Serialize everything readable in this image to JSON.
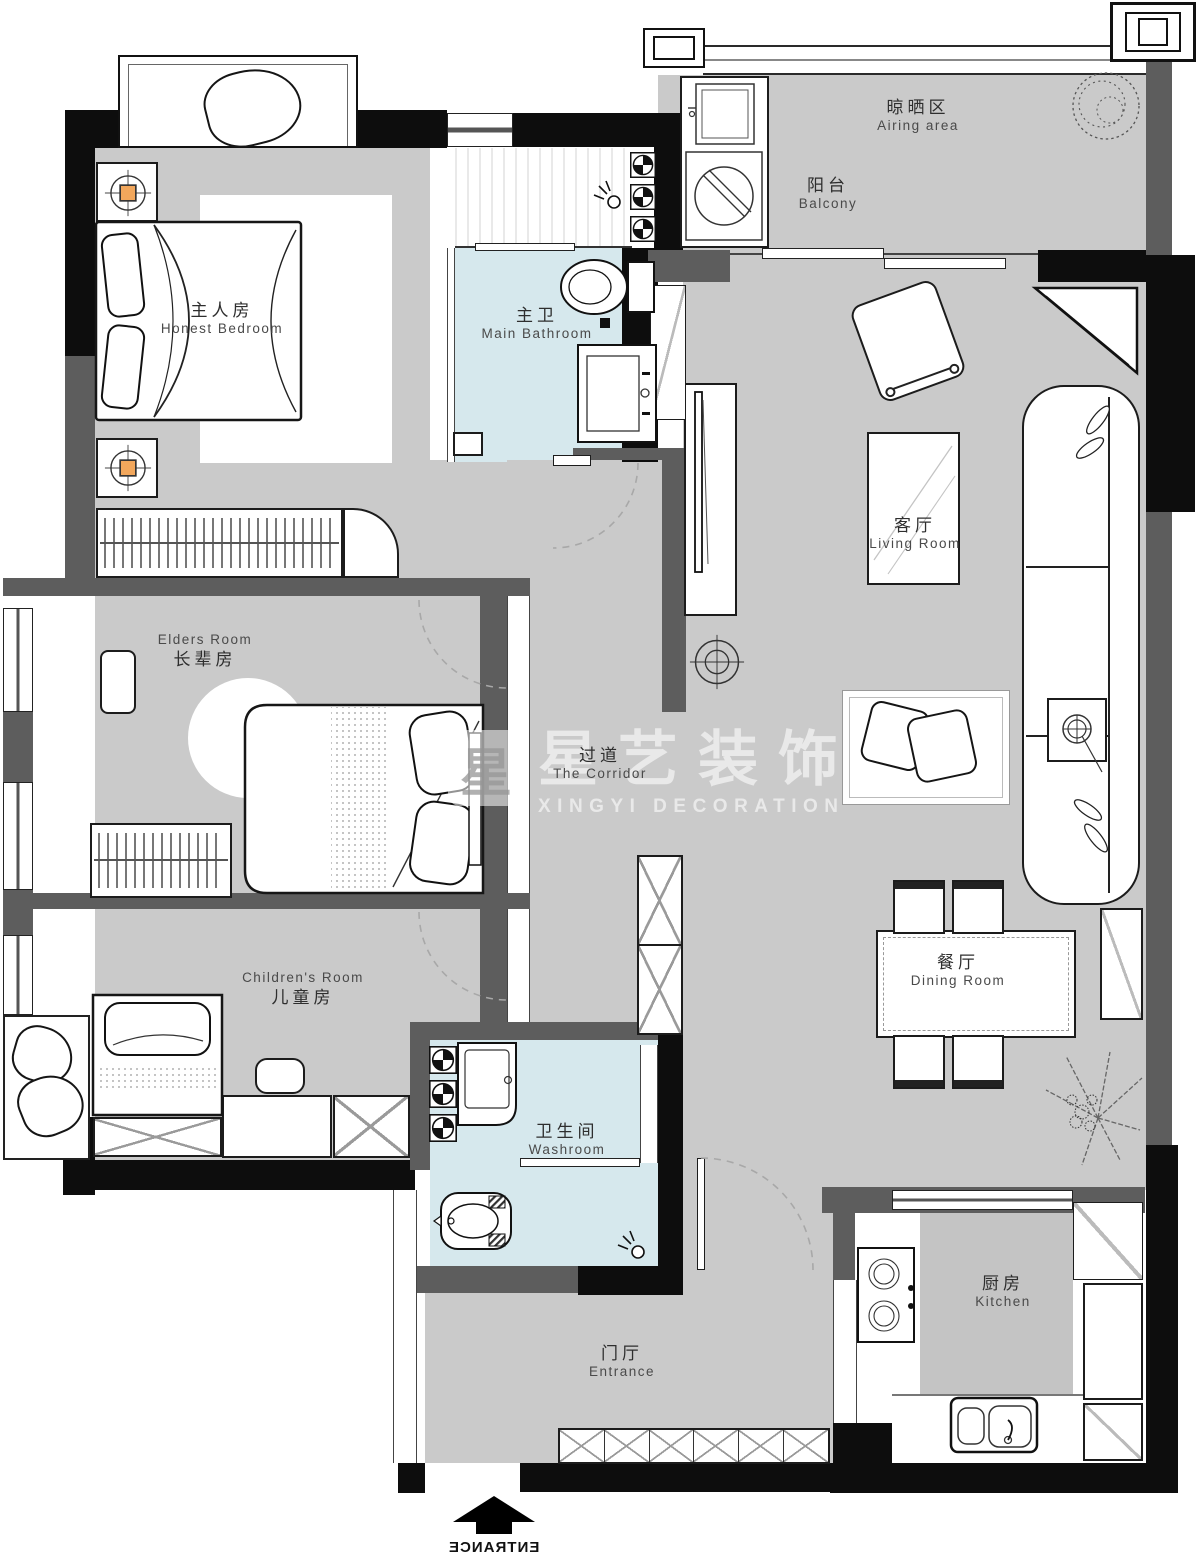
{
  "watermark": {
    "logo_char": "星",
    "title_zh": "星艺装饰",
    "title_en": "XINGYI DECORATION"
  },
  "entrance_marker": "ENTRANCE",
  "rooms": {
    "master_bedroom": {
      "zh": "主人房",
      "en": "Honest Bedroom"
    },
    "main_bathroom": {
      "zh": "主卫",
      "en": "Main Bathroom"
    },
    "airing_area": {
      "zh": "晾晒区",
      "en": "Airing area"
    },
    "balcony": {
      "zh": "阳台",
      "en": "Balcony"
    },
    "living_room": {
      "zh": "客厅",
      "en": "Living Room"
    },
    "elders_room": {
      "zh": "长辈房",
      "en": "Elders Room"
    },
    "corridor": {
      "zh": "过道",
      "en": "The Corridor"
    },
    "children_room": {
      "zh": "儿童房",
      "en": "Children's Room"
    },
    "washroom": {
      "zh": "卫生间",
      "en": "Washroom"
    },
    "dining_room": {
      "zh": "餐厅",
      "en": "Dining Room"
    },
    "entrance": {
      "zh": "门厅",
      "en": "Entrance"
    },
    "kitchen": {
      "zh": "厨房",
      "en": "Kitchen"
    }
  },
  "colors": {
    "floor_gray": "#cacaca",
    "bathroom_blue": "#d6e8ed",
    "wall_black": "#0d0d0d",
    "wall_gray": "#5d5d5d",
    "lamp_orange": "#f2a75c",
    "watermark_white": "rgba(255,255,255,0.58)"
  }
}
